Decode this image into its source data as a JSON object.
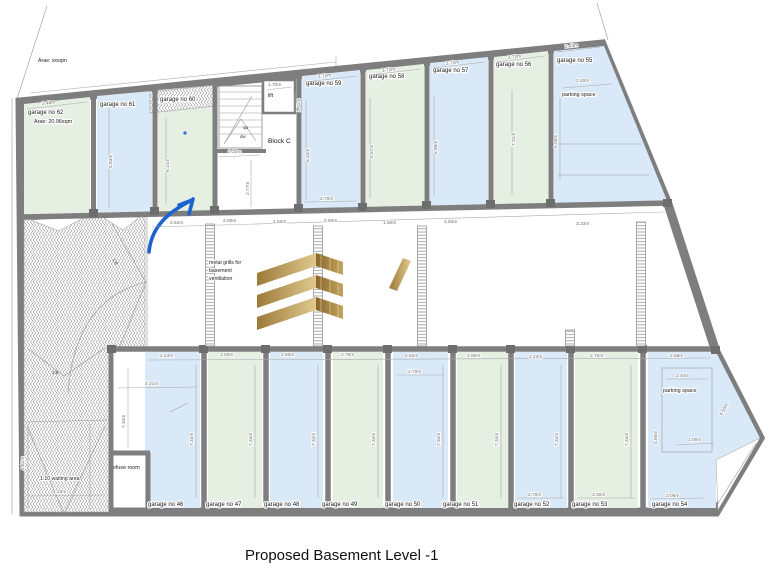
{
  "title": "Proposed Basement Level -1",
  "site_note": "Arae: xxsqm",
  "block_c": {
    "label": "Block C",
    "lift": "lift",
    "up": "up",
    "dw": "dw"
  },
  "notes": {
    "vent1": "metal grills for",
    "vent2": "basement",
    "vent3": "ventilation",
    "refuse": "refuse room",
    "waiting": "1:10 waiting area",
    "grade": "1:8",
    "parking": "parking space"
  },
  "garages": {
    "g46": "garage no 46",
    "g47": "garage no 47",
    "g48": "garage no 48",
    "g49": "garage no 49",
    "g50": "garage no 50",
    "g51": "garage no 51",
    "g52": "garage no 52",
    "g53": "garage no 53",
    "g54": "garage no 54",
    "g55": "garage no 55",
    "g56": "garage no 56",
    "g57": "garage no 57",
    "g58": "garage no 58",
    "g59": "garage no 59",
    "g60": "garage no 60",
    "g61": "garage no 61",
    "g62": "garage no 62",
    "g62_area": "Arae: 20.96sqm"
  },
  "dims": {
    "m100": "1.00m",
    "m150": "1.50m",
    "m152": "1.52m",
    "m170": "1.70m",
    "m171": "1.71m",
    "m200": "2.00m",
    "m232": "2.32m",
    "m240": "2.40m",
    "m242": "2.42m",
    "m243": "2.43m",
    "m250": "2.50m",
    "m253": "2.53m",
    "m254": "2.54m",
    "m262": "2.62m",
    "m268": "2.68m",
    "m270": "2.70m",
    "m272": "2.72m",
    "m275": "2.75m",
    "m277": "2.77m",
    "m280": "2.80m",
    "m293": "2.93m",
    "m300": "3.00m",
    "m306": "3.06m",
    "m330": "3.30m",
    "m333": "3.33m",
    "m348": "3.48m",
    "m372": "3.72m",
    "m421": "4.21m",
    "m422": "4.22m",
    "m450": "4.50m",
    "m480": "4.80m",
    "m481": "4.81m",
    "m500": "5.00m",
    "m583": "5.83m",
    "m614": "6.14m",
    "m634": "6.34m",
    "m697": "6.97m",
    "m698": "6.98m",
    "m731": "7.31m",
    "m734": "7.34m"
  },
  "colors": {
    "garage_green": "#e5efe2",
    "garage_blue": "#d9e9f7",
    "wall_gray": "#7e7e7e",
    "logo_gold": "#c2a255",
    "arrow_blue": "#1c63cf"
  }
}
